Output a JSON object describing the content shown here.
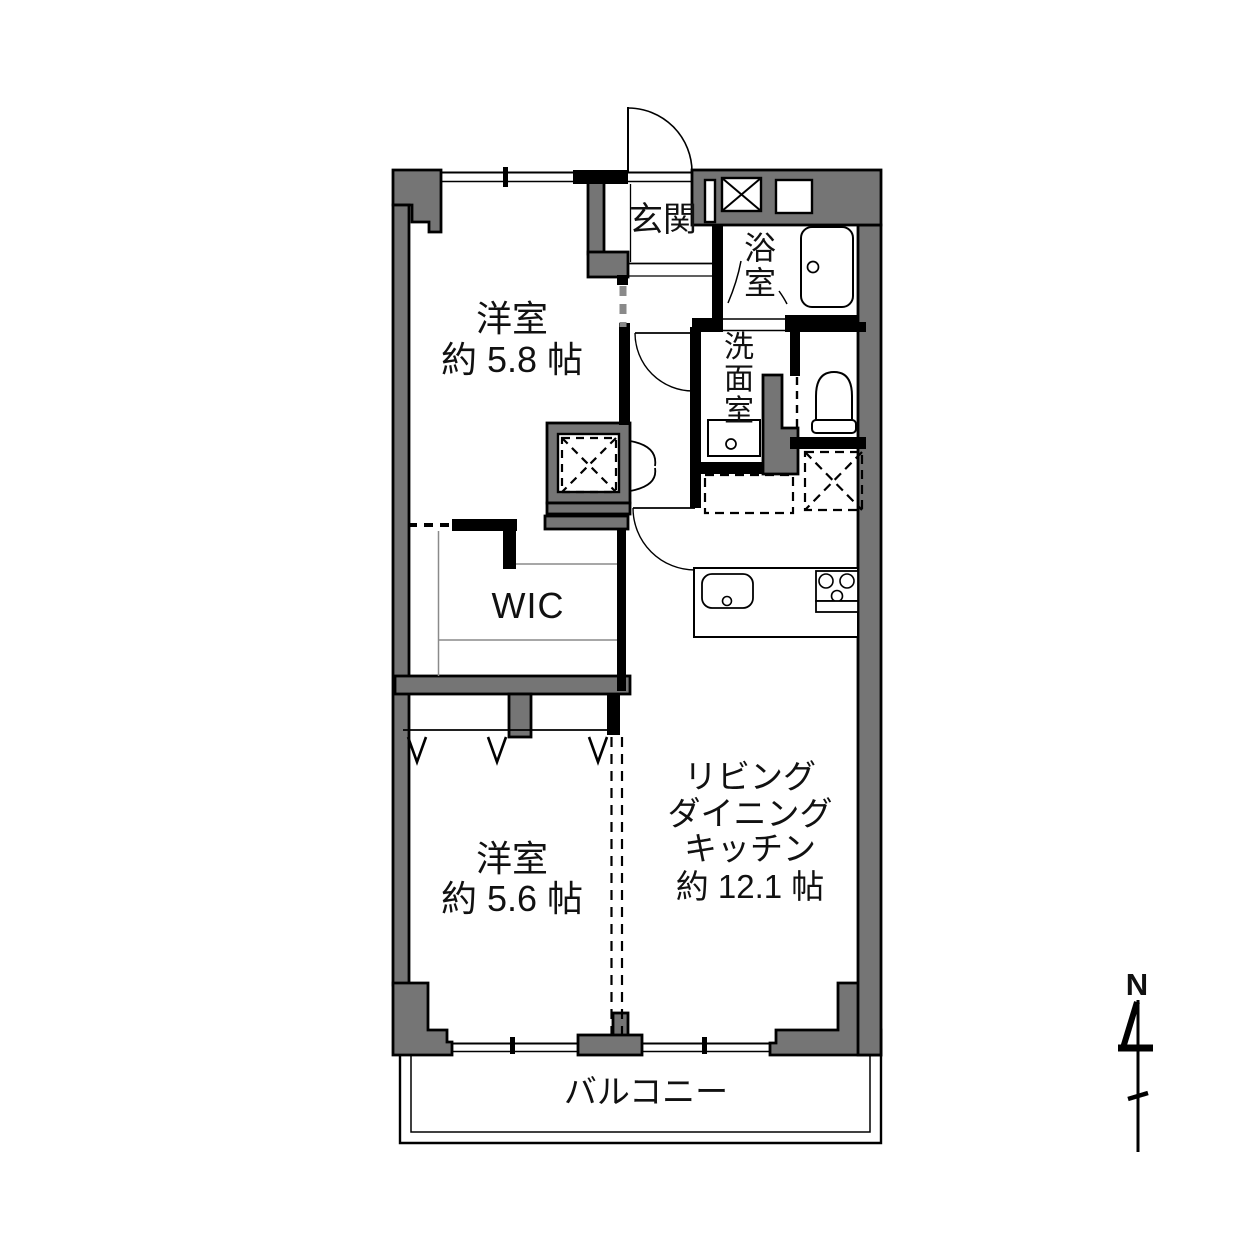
{
  "floor_plan": {
    "background": "#ffffff",
    "wall_fill": "#757575",
    "line_color": "#000000",
    "rooms": {
      "bedroom1": {
        "label": "洋室",
        "size": "約 5.8 帖"
      },
      "entrance": {
        "label": "玄関"
      },
      "bathroom": {
        "chars": [
          "浴",
          "室"
        ]
      },
      "washroom": {
        "chars": [
          "洗",
          "面",
          "室"
        ]
      },
      "wic": {
        "label": "WIC"
      },
      "bedroom2": {
        "label": "洋室",
        "size": "約 5.6 帖"
      },
      "ldk": {
        "lines": [
          "リビング",
          "ダイニング",
          "キッチン",
          "約 12.1 帖"
        ]
      },
      "balcony": {
        "label": "バルコニー"
      }
    },
    "compass": {
      "label": "N"
    }
  }
}
